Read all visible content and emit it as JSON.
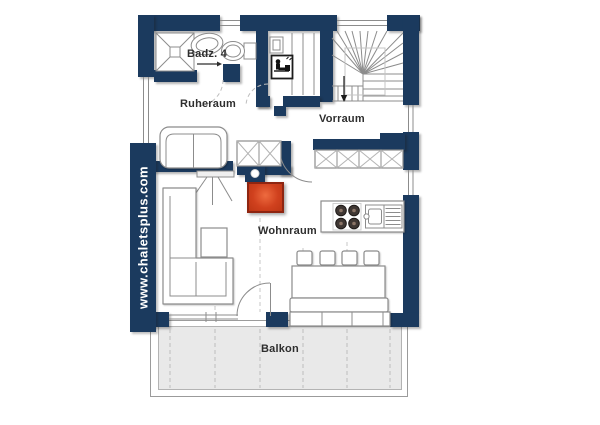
{
  "watermark": {
    "text": "www.chaletsplus.com"
  },
  "rooms": {
    "bathroom": {
      "label": "Badz. 4"
    },
    "resting_room": {
      "label": "Ruheraum"
    },
    "hall": {
      "label": "Vorraum"
    },
    "living_room": {
      "label": "Wohnraum"
    },
    "balcony": {
      "label": "Balkon"
    }
  },
  "icons": [
    "shower-icon",
    "washbasin-icon",
    "toilet-icon",
    "sauna-icon",
    "sauna-heater-icon",
    "winder-stairs-icon",
    "stairs-down-arrow-icon",
    "wardrobe-icon",
    "tiled-stove-icon",
    "chimney-icon",
    "loveseat-sofa-icon",
    "corner-sofa-icon",
    "side-table-icon",
    "tv-easel-icon",
    "hob-icon",
    "kitchen-sink-icon",
    "dining-table-icon",
    "chair-icon",
    "bench-icon",
    "window-icon",
    "door-swing-icon",
    "balcony-deck"
  ],
  "colors": {
    "wall": "#1b3a5e",
    "stove": "#d0411e",
    "stove_border": "#8e2511",
    "deck": "#e9e9e9",
    "line": "#8c8c8c",
    "label": "#2e2e2e",
    "watermark": "#ffffff",
    "background": "#ffffff"
  }
}
